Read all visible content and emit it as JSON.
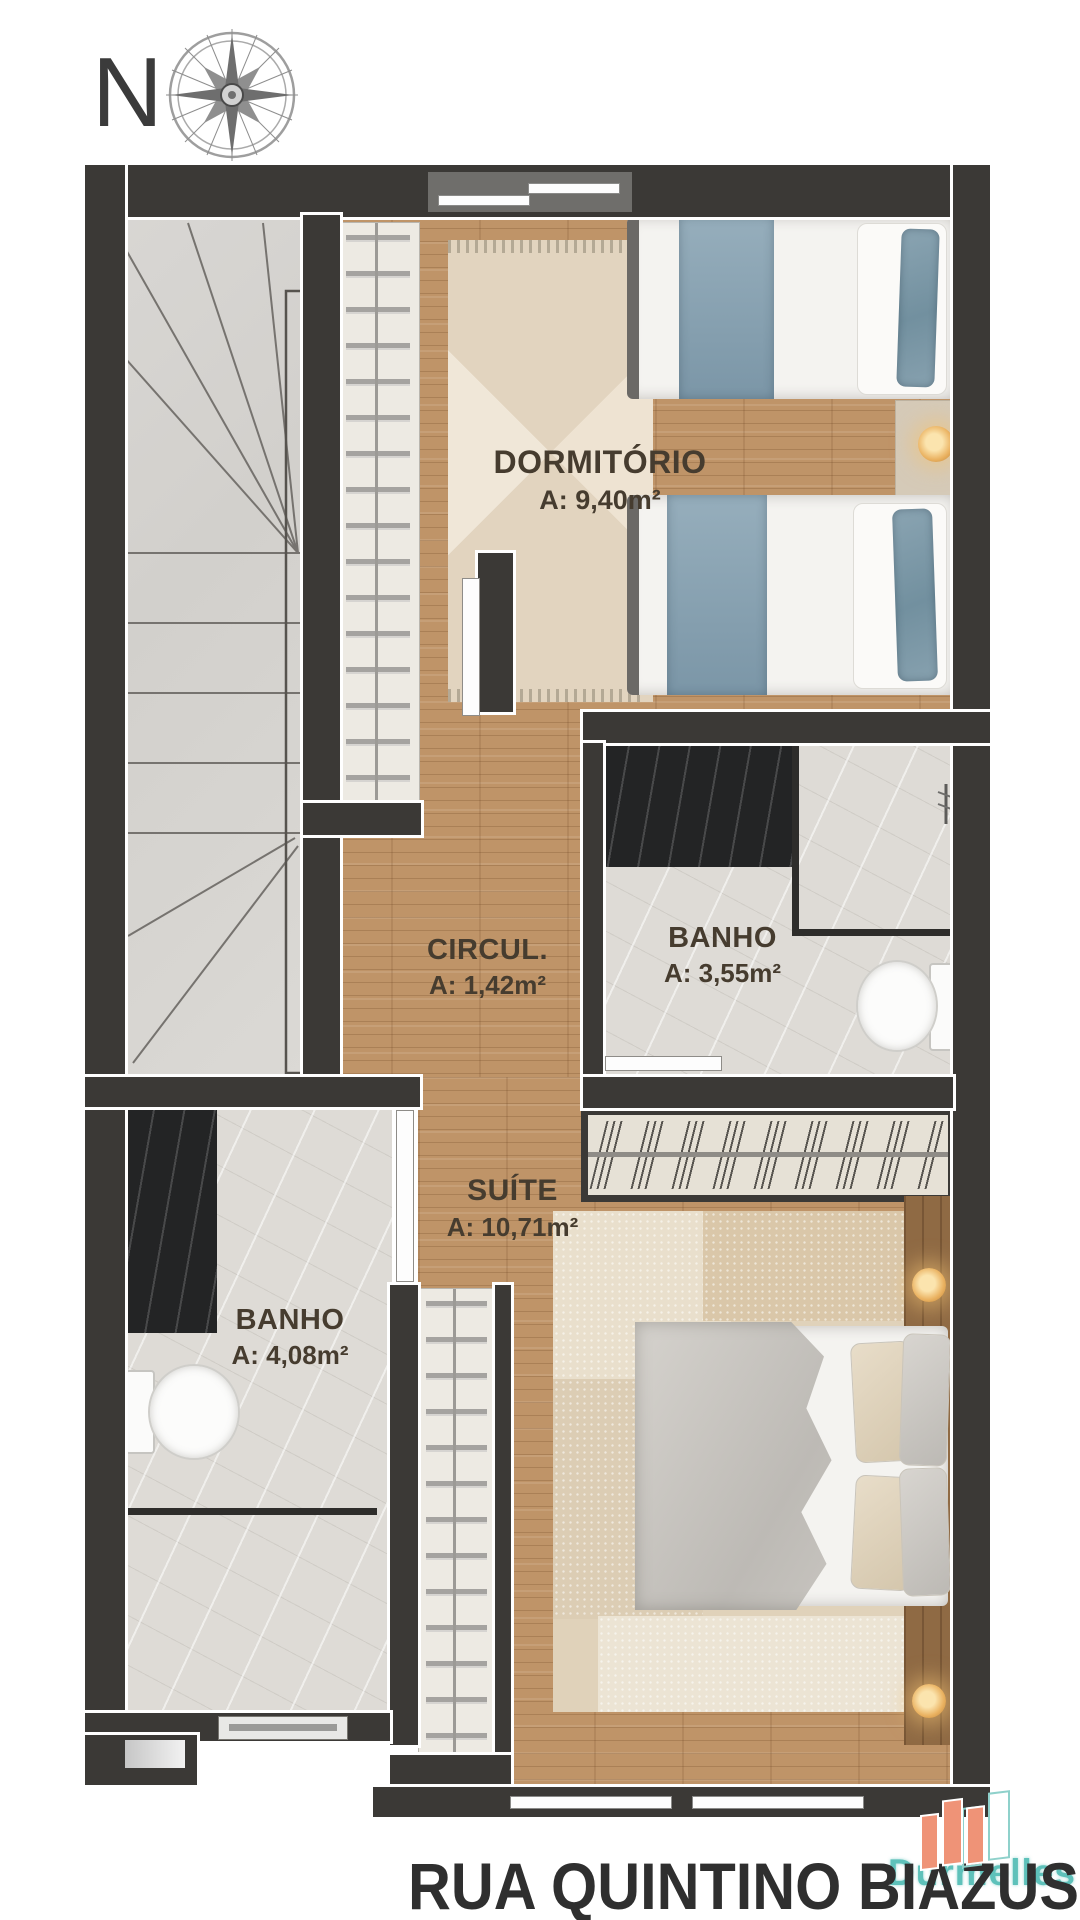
{
  "compass": {
    "label": "N"
  },
  "plan": {
    "rooms": [
      {
        "name": "DORMITÓRIO",
        "area": "A: 9,40m²"
      },
      {
        "name": "CIRCUL.",
        "area": "A: 1,42m²"
      },
      {
        "name": "BANHO",
        "area": "A: 3,55m²"
      },
      {
        "name": "SUÍTE",
        "area": "A: 10,71m²"
      },
      {
        "name": "BANHO",
        "area": "A: 4,08m²"
      }
    ]
  },
  "street_label": "RUA QUINTINO BIAZUS",
  "watermark": {
    "brand": "Durmelles"
  },
  "colors": {
    "wall": "#3b3936",
    "wood": "#bf9468",
    "marble": "#dedbd6",
    "bedding_blue": "#7e99aa",
    "watermark_teal": "#5ec1ba",
    "watermark_orange": "#ef9377"
  }
}
